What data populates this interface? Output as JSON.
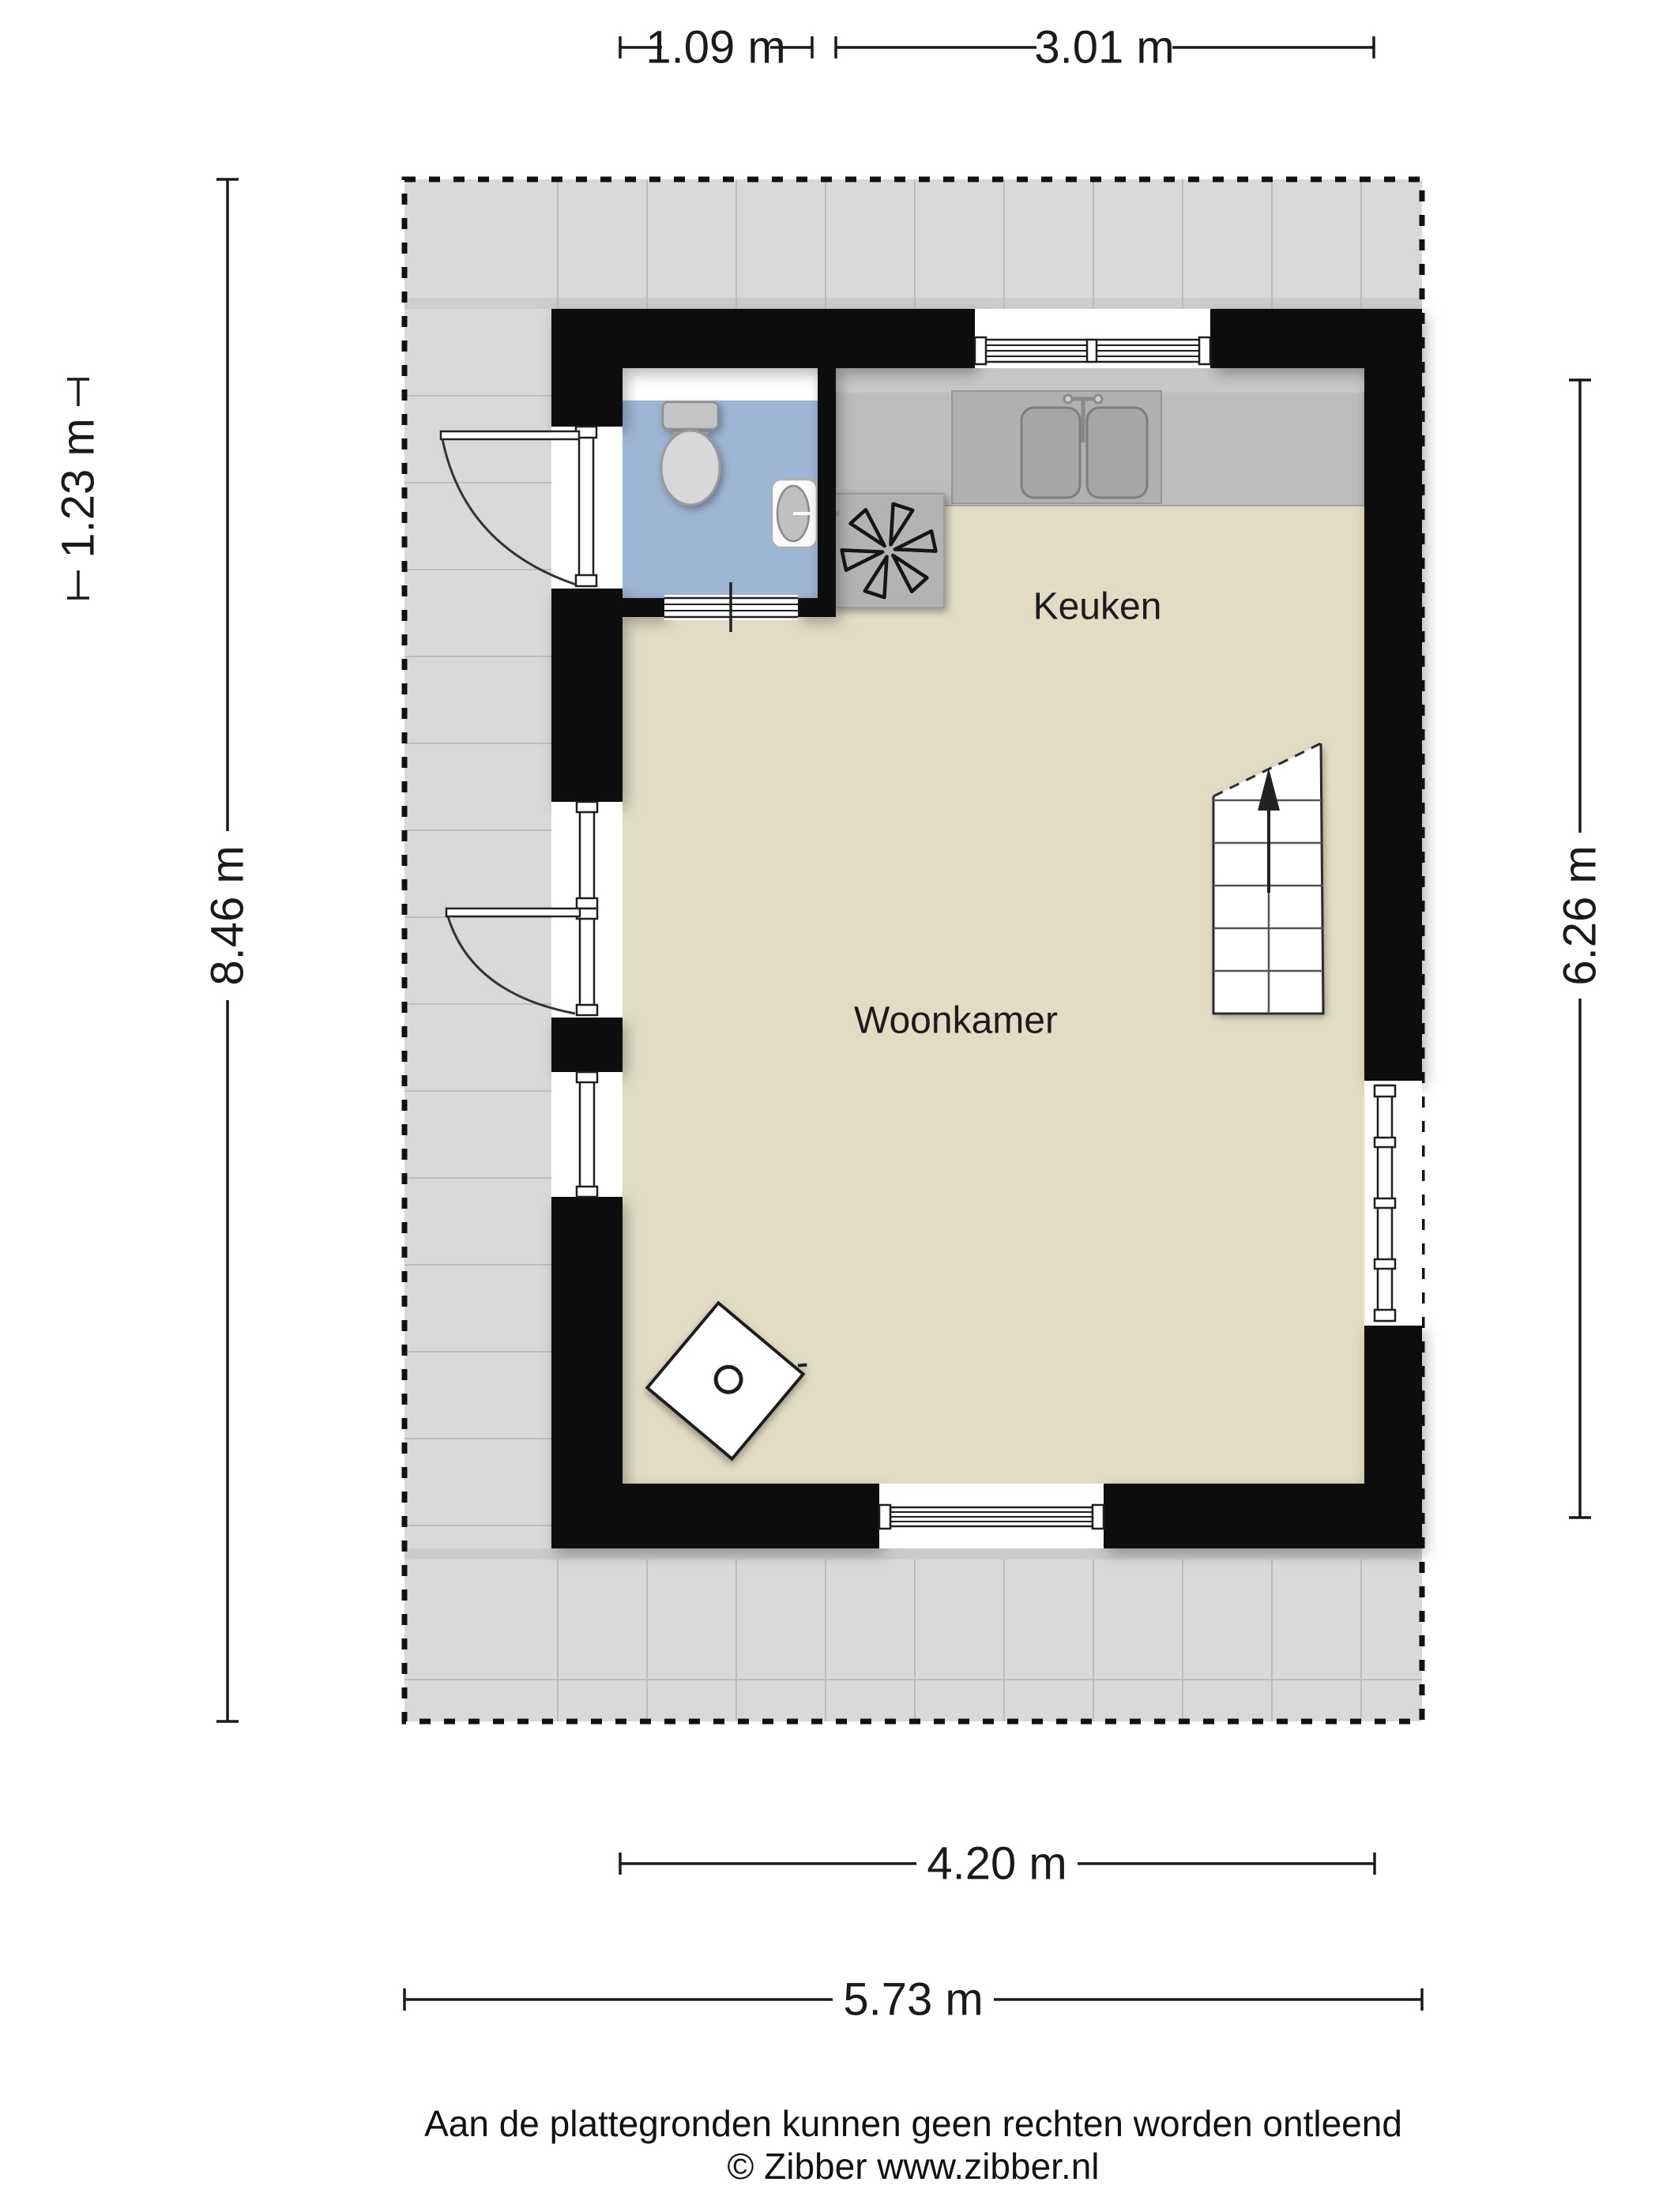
{
  "plan": {
    "title_rooms": [
      {
        "label": "Keuken"
      },
      {
        "label": "Woonkamer"
      }
    ],
    "dimensions": {
      "top_left": "1.09 m",
      "top_right": "3.01 m",
      "left_upper": "1.23 m",
      "left_full": "8.46 m",
      "right": "6.26 m",
      "bottom_inner": "4.20 m",
      "bottom_outer": "5.73 m"
    },
    "footer": {
      "line1": "Aan de plattegronden kunnen geen rechten worden ontleend",
      "line2": "© Zibber www.zibber.nl"
    },
    "colors": {
      "wall": "#0d0d0d",
      "floor_beige": "#e3dcc5",
      "bathroom_blue": "#9fb5d5",
      "terrace_gray": "#d9d9d9",
      "terrace_line": "#bcbcbc",
      "counter_gray": "#bdbdbd",
      "counter_inner": "#b0b0b0",
      "basin_gray": "#a6a6a6",
      "hob_gray": "#b3b3b3",
      "fixture_gray": "#c9c9c9",
      "dim_line": "#1a1a1a"
    }
  }
}
